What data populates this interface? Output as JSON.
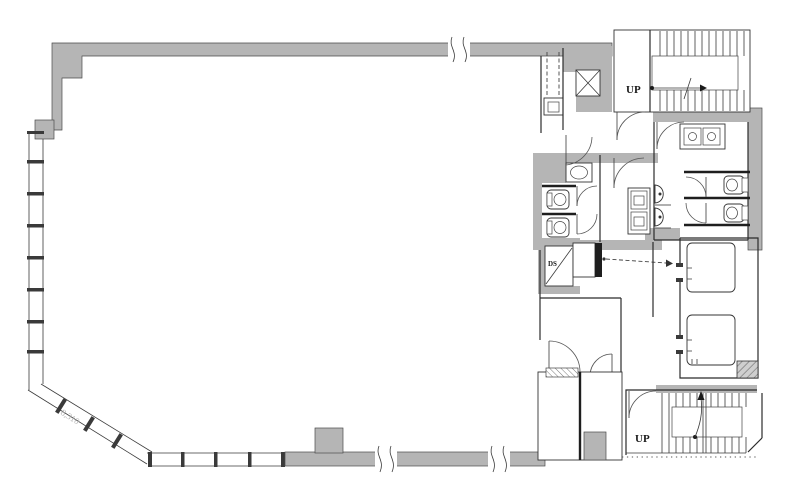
{
  "document": {
    "type": "floor-plan"
  },
  "labels": {
    "stair_north_up": "UP",
    "stair_south_up": "UP",
    "duct_space": "DS",
    "dimension": "8,310"
  },
  "colors": {
    "wall_fill": "#b5b5b5",
    "line": "#2b2b2b",
    "background": "#ffffff",
    "faint_text": "#b4b4b4"
  },
  "fixtures": {
    "staircases": 2,
    "elevators": 2,
    "toilet_stalls": 4,
    "urinals": 2,
    "wash_basins": 3
  }
}
